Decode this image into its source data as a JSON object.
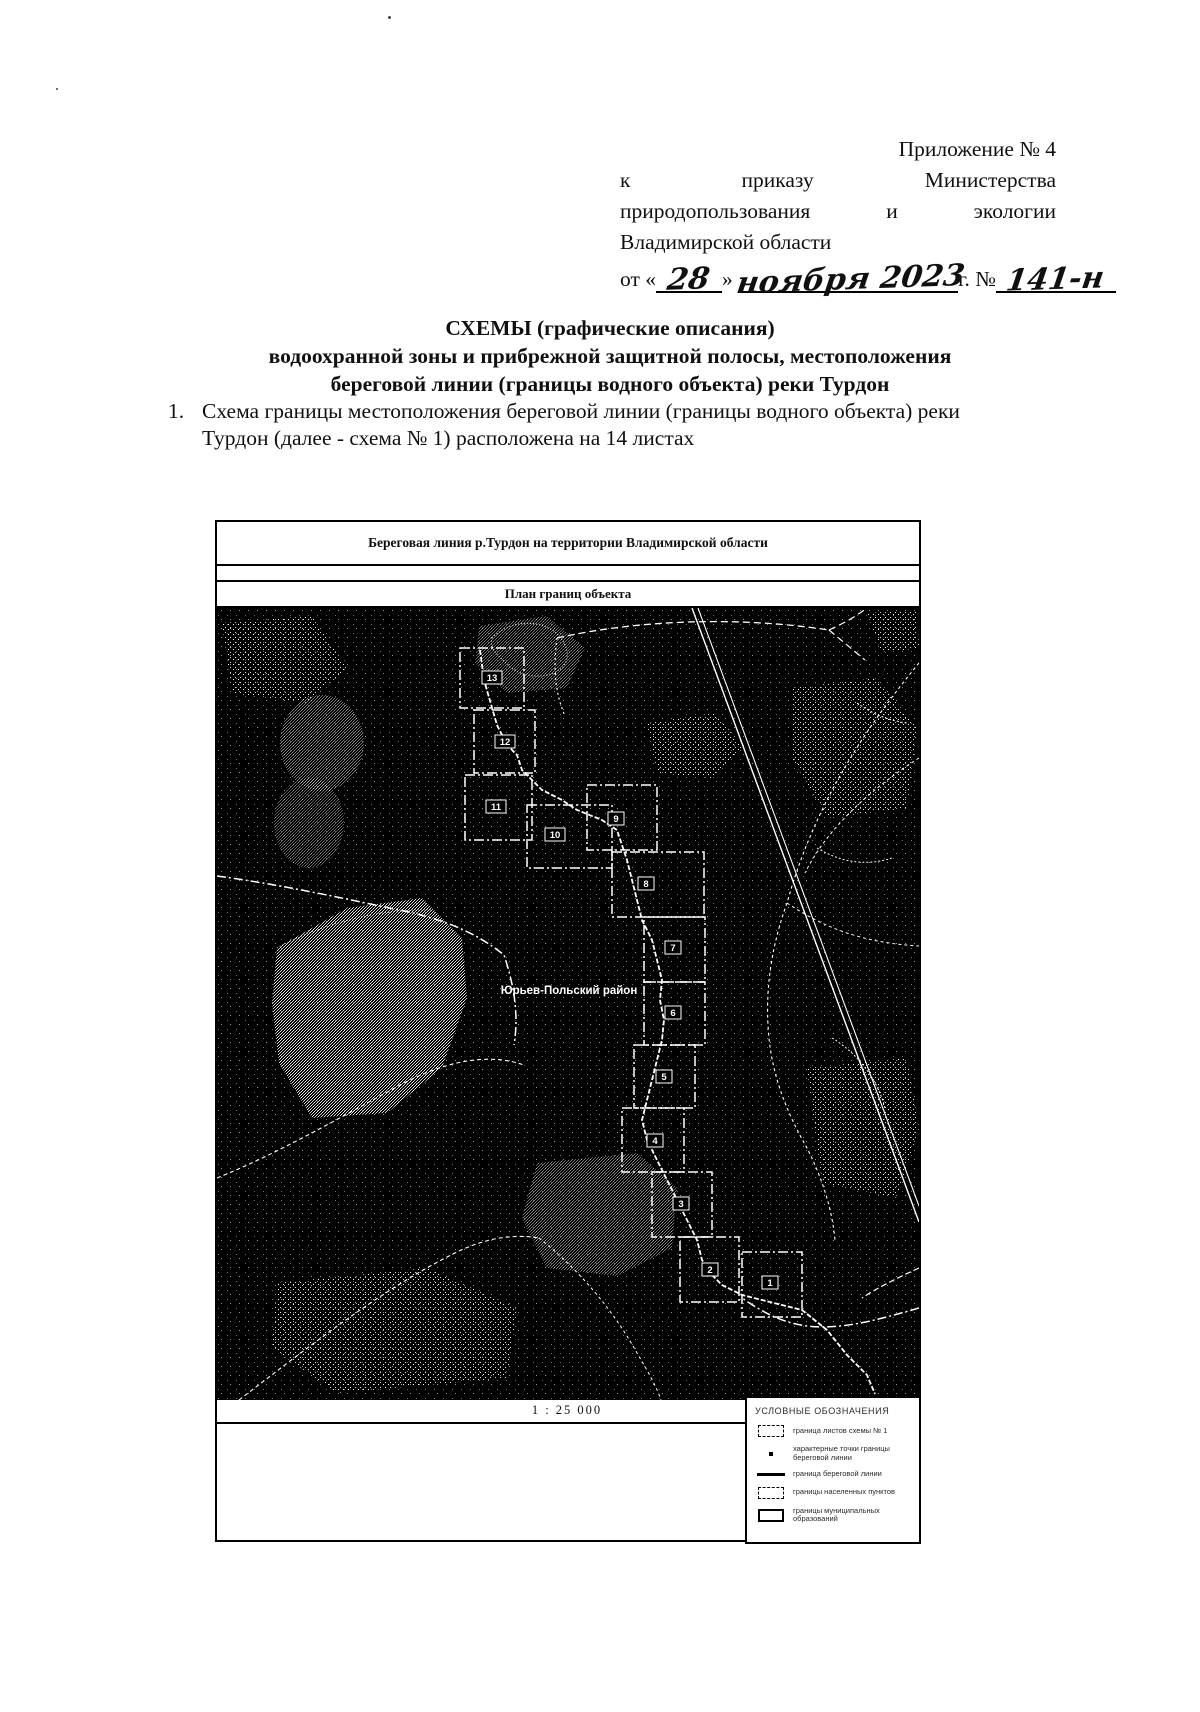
{
  "doc": {
    "header_right": {
      "line1": "Приложение № 4",
      "line2_words": [
        "к",
        "приказу",
        "Министерства"
      ],
      "line3_words": [
        "природопользования",
        "и",
        "экологии"
      ],
      "line4": "Владимирской области",
      "date": {
        "prefix": "от «",
        "day": "28",
        "close": "»",
        "month_year": "ноября 2023",
        "g": "г. №",
        "number": "141-н"
      }
    },
    "title": {
      "line1": "СХЕМЫ (графические описания)",
      "line2": "водоохранной зоны и прибрежной защитной полосы, местоположения",
      "line3": "береговой линии (границы водного объекта) реки Турдон"
    },
    "item": {
      "number": "1.",
      "text": "Схема границы местоположения береговой линии (границы водного объекта) реки Турдон (далее - схема № 1) расположена на 14 листах"
    }
  },
  "figure": {
    "title": "Береговая линия р.Турдон на территории Владимирской области",
    "subtitle": "План границ объекта",
    "scale": "1 : 25 000",
    "map_label": "Юрьев-Польский район",
    "sheet_numbers": [
      "1",
      "2",
      "3",
      "4",
      "5",
      "6",
      "7",
      "8",
      "9",
      "10",
      "11",
      "12",
      "13"
    ],
    "legend": {
      "title": "УСЛОВНЫЕ ОБОЗНАЧЕНИЯ",
      "items": [
        {
          "symbol": "dashdot-rect-icon",
          "label": "граница листов схемы № 1"
        },
        {
          "symbol": "point-icon",
          "label": "характерные точки границы береговой линии"
        },
        {
          "symbol": "solid-line-icon",
          "label": "граница береговой линии"
        },
        {
          "symbol": "dashed-rect-icon",
          "label": "границы населенных пунктов"
        },
        {
          "symbol": "bold-rect-icon",
          "label": "границы муниципальных образований"
        }
      ]
    },
    "map_colors": {
      "background": "#000000",
      "lines": "#ffffff"
    }
  }
}
